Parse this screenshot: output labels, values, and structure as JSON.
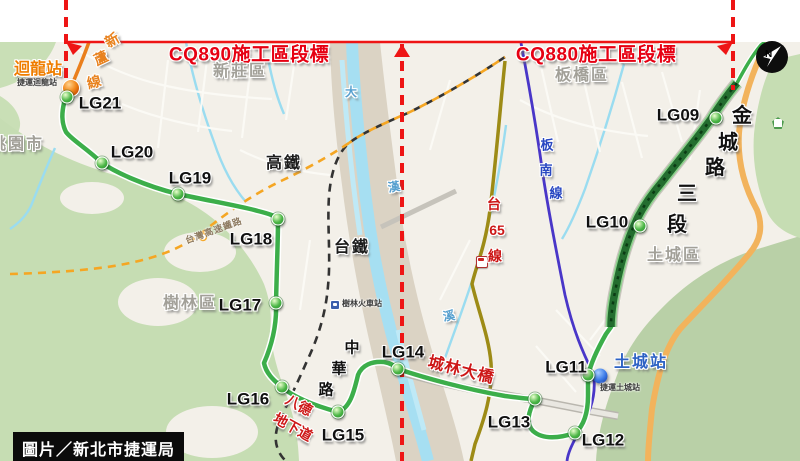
{
  "credit": "圖片／新北市捷運局",
  "compass": {
    "letter": "N"
  },
  "colors": {
    "annotation_red": "#e60012",
    "route_green": "#3cae4a",
    "segment_dark_green": "#236d2f",
    "xinlu_orange": "#ea7f1c",
    "bannan_purple": "#4936c8",
    "hsr_dash_orange": "#f5a623",
    "water_blue": "#a6dff2",
    "tai65_olive": "#9d8b16"
  },
  "stations": [
    {
      "code": "LG21",
      "dot": [
        67,
        97
      ],
      "label": [
        100,
        103
      ]
    },
    {
      "code": "LG20",
      "dot": [
        102,
        163
      ],
      "label": [
        132,
        152
      ]
    },
    {
      "code": "LG19",
      "dot": [
        178,
        194
      ],
      "label": [
        190,
        178
      ]
    },
    {
      "code": "LG18",
      "dot": [
        278,
        219
      ],
      "label": [
        251,
        239
      ]
    },
    {
      "code": "LG17",
      "dot": [
        276,
        303
      ],
      "label": [
        240,
        305
      ]
    },
    {
      "code": "LG16",
      "dot": [
        282,
        387
      ],
      "label": [
        248,
        399
      ]
    },
    {
      "code": "LG15",
      "dot": [
        338,
        412
      ],
      "label": [
        343,
        435
      ]
    },
    {
      "code": "LG14",
      "dot": [
        398,
        369
      ],
      "label": [
        403,
        352
      ]
    },
    {
      "code": "LG13",
      "dot": [
        535,
        399
      ],
      "label": [
        509,
        422
      ]
    },
    {
      "code": "LG12",
      "dot": [
        575,
        433
      ],
      "label": [
        603,
        440
      ]
    },
    {
      "code": "LG11",
      "dot": [
        588,
        375
      ],
      "label": [
        566,
        367
      ]
    },
    {
      "code": "LG10",
      "dot": [
        640,
        226
      ],
      "label": [
        607,
        222
      ]
    },
    {
      "code": "LG09",
      "dot": [
        716,
        118
      ],
      "label": [
        678,
        115
      ]
    }
  ],
  "markers": [
    {
      "n": "huilong-terminal-marker",
      "type": "orange",
      "x": 71,
      "y": 88,
      "d": 16
    },
    {
      "n": "tucheng-terminal-marker",
      "type": "blue",
      "x": 600,
      "y": 376,
      "d": 15
    }
  ],
  "labels": [
    {
      "n": "cq890-label",
      "t": "CQ890施工區段標",
      "x": 249,
      "y": 55,
      "k": "seg"
    },
    {
      "n": "cq880-label",
      "t": "CQ880施工區段標",
      "x": 596,
      "y": 55,
      "k": "seg"
    },
    {
      "n": "huilong-station-name",
      "t": "迴龍站",
      "x": 38,
      "y": 70,
      "k": "term-orange"
    },
    {
      "n": "huilong-station-sub",
      "t": "捷運迴龍站",
      "x": 37,
      "y": 83,
      "k": "tiny"
    },
    {
      "n": "district-taoyuan",
      "t": "桃園市",
      "x": 17,
      "y": 145,
      "k": "district"
    },
    {
      "n": "district-xinzhuang",
      "t": "新莊區",
      "x": 240,
      "y": 72,
      "k": "district"
    },
    {
      "n": "district-banqiao",
      "t": "板橋區",
      "x": 582,
      "y": 76,
      "k": "district"
    },
    {
      "n": "district-shulin",
      "t": "樹林區",
      "x": 190,
      "y": 304,
      "k": "district"
    },
    {
      "n": "district-tucheng",
      "t": "土城區",
      "x": 674,
      "y": 256,
      "k": "district"
    },
    {
      "n": "hsr-label",
      "t": "高鐵",
      "x": 284,
      "y": 164,
      "k": "rail"
    },
    {
      "n": "tra-label",
      "t": "台鐵",
      "x": 352,
      "y": 248,
      "k": "rail"
    },
    {
      "n": "hsr-line-name",
      "t": "台灣高速鐵路",
      "x": 214,
      "y": 231,
      "k": "hsr-tiny",
      "r": -20
    },
    {
      "n": "shulin-rail-station",
      "t": "樹林火車站",
      "x": 362,
      "y": 304,
      "k": "tiny"
    },
    {
      "n": "tucheng-station-name",
      "t": "土城站",
      "x": 641,
      "y": 363,
      "k": "term-blue"
    },
    {
      "n": "tucheng-station-sub",
      "t": "捷運土城站",
      "x": 620,
      "y": 388,
      "k": "tiny"
    },
    {
      "n": "chenglin-bridge-label",
      "t": "城林大橋",
      "x": 461,
      "y": 371,
      "k": "red-road",
      "r": 14
    },
    {
      "n": "bade-underpass-label-1",
      "t": "八德",
      "x": 299,
      "y": 405,
      "k": "red-road-sm",
      "r": 29
    },
    {
      "n": "bade-underpass-label-2",
      "t": "地下道",
      "x": 293,
      "y": 427,
      "k": "red-road-sm",
      "r": 29
    }
  ],
  "vlabels": [
    {
      "n": "jincheng-road-label",
      "k": "road-big",
      "cells": [
        "金",
        "城",
        "路",
        "三",
        "段"
      ],
      "pos": [
        [
          742,
          116
        ],
        [
          728,
          143
        ],
        [
          715,
          168
        ],
        [
          687,
          194
        ],
        [
          677,
          225
        ]
      ]
    },
    {
      "n": "zhonghua-road-label",
      "k": "road-mid",
      "cells": [
        "中",
        "華",
        "路"
      ],
      "pos": [
        [
          352,
          348
        ],
        [
          339,
          369
        ],
        [
          326,
          390
        ]
      ]
    },
    {
      "n": "bannan-line-label",
      "k": "metro-blue",
      "cells": [
        "板",
        "南",
        "線"
      ],
      "pos": [
        [
          547,
          145
        ],
        [
          546,
          170
        ],
        [
          556,
          193
        ]
      ]
    },
    {
      "n": "tai65-road-label",
      "k": "red-road-sm",
      "cells": [
        "台",
        "65",
        "線"
      ],
      "pos": [
        [
          494,
          204
        ],
        [
          497,
          230
        ],
        [
          495,
          256
        ]
      ]
    },
    {
      "n": "xinlu-line-label",
      "k": "xinlu",
      "cells": [
        "新",
        "蘆",
        "線"
      ],
      "pos": [
        [
          112,
          40
        ],
        [
          101,
          58
        ],
        [
          94,
          82
        ]
      ],
      "rot": [
        -30,
        -25,
        -15
      ]
    },
    {
      "n": "dahan-river-label",
      "k": "river",
      "cells": [
        "大",
        "漢",
        "溪"
      ],
      "pos": [
        [
          351,
          92
        ],
        [
          394,
          187
        ],
        [
          449,
          316
        ]
      ],
      "rot": [
        0,
        -10,
        -10
      ]
    }
  ]
}
